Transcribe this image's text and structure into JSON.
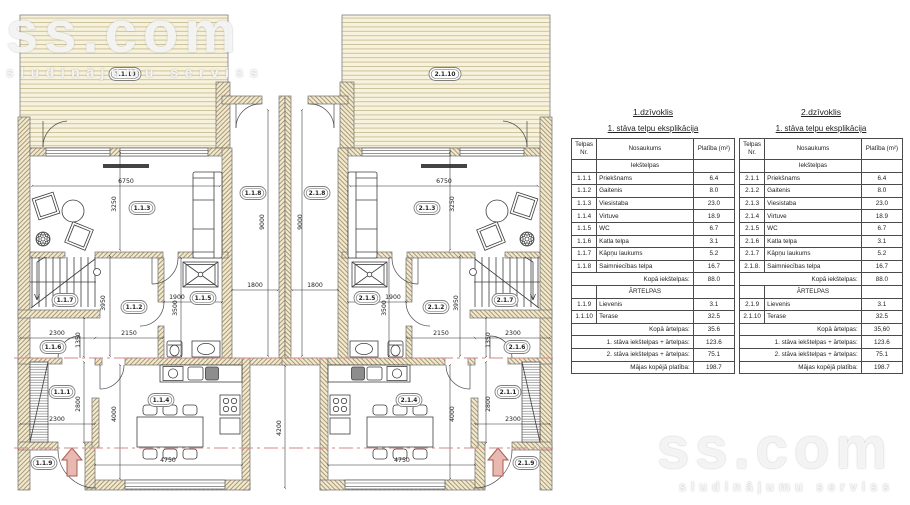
{
  "watermark": {
    "brand": "ss.com",
    "tagline": "sludinājumu serviss"
  },
  "colors": {
    "wall_hatch": "#a5936c",
    "wall_fill": "#f0e8cf",
    "deck_fill": "#f7f2dd",
    "deck_line": "#c3b88b",
    "section_line": "#d58a8a",
    "entry_arrow": "#e7b9b1"
  },
  "plan": {
    "rooms": {
      "u1_terrace": "1.1.10",
      "u1_living": "1.1.3",
      "u1_utility": "1.1.8",
      "u1_stairs": "1.1.7",
      "u1_hall2": "1.1.2",
      "u1_wc": "1.1.5",
      "u1_boiler": "1.1.6",
      "u1_entry": "1.1.1",
      "u1_kitchen": "1.1.4",
      "u1_porch": "1.1.9",
      "u2_terrace": "2.1.10",
      "u2_living": "2.1.3",
      "u2_utility": "2.1.8",
      "u2_stairs": "2.1.7",
      "u2_hall2": "2.1.2",
      "u2_wc": "2.1.5",
      "u2_boiler": "2.1.6",
      "u2_entry": "2.1.1",
      "u2_kitchen": "2.1.4",
      "u2_porch": "2.1.9"
    },
    "dims": {
      "living_w": "6750",
      "living_h": "3250",
      "corridor_h": "3950",
      "wc_h": "3500",
      "wc_w": "1900",
      "boiler_w": "2300",
      "boiler_h": "1350",
      "corridor_w": "2150",
      "hall_h": "2800",
      "hall_w": "2300",
      "kitchen_h": "4000",
      "kitchen_w": "4750",
      "utility_w": "1800",
      "utility_h": "9000",
      "court_h": "4200"
    }
  },
  "tables": [
    {
      "title": "1.dzīvoklis",
      "subtitle": "1. stāva telpu eksplikācija",
      "columns": [
        "Telpas Nr.",
        "Nosaukums",
        "Platība (m²)"
      ],
      "section_inner": "Iekštelpas",
      "rows_inner": [
        [
          "1.1.1",
          "Priekšnams",
          "6.4"
        ],
        [
          "1.1.2",
          "Gaitenis",
          "8.0"
        ],
        [
          "1.1.3",
          "Viesistaba",
          "23.0"
        ],
        [
          "1.1.4",
          "Virtuve",
          "18.9"
        ],
        [
          "1.1.5",
          "WC",
          "6.7"
        ],
        [
          "1.1.6",
          "Katla telpa",
          "3.1"
        ],
        [
          "1.1.7",
          "Kāpņu laukums",
          "5.2"
        ],
        [
          "1.1.8",
          "Saimniecības telpa",
          "16.7"
        ]
      ],
      "total_inner": [
        "Kopā iekštelpas:",
        "88.0"
      ],
      "section_outer": "ĀRTELPAS",
      "rows_outer": [
        [
          "1.1.9",
          "Lievenis",
          "3.1"
        ],
        [
          "1.1.10",
          "Terase",
          "32.5"
        ]
      ],
      "total_outer": [
        "Kopā ārtelpas:",
        "35.6"
      ],
      "summary": [
        [
          "1. stāva iekštelpas + ārtelpas:",
          "123.6"
        ],
        [
          "2. stāva iekštelpas + ārtelpas:",
          "75.1"
        ],
        [
          "Mājas kopējā platība:",
          "198.7"
        ]
      ]
    },
    {
      "title": "2.dzīvoklis",
      "subtitle": "1. stāva telpu eksplikācija",
      "columns": [
        "Telpas Nr.",
        "Nosaukums",
        "Platība (m²)"
      ],
      "section_inner": "Iekštelpas",
      "rows_inner": [
        [
          "2.1.1",
          "Priekšnams",
          "6.4"
        ],
        [
          "2.1.2",
          "Gaitenis",
          "8.0"
        ],
        [
          "2.1.3",
          "Viesistaba",
          "23.0"
        ],
        [
          "2.1.4",
          "Virtuve",
          "18.9"
        ],
        [
          "2.1.5",
          "WC",
          "6.7"
        ],
        [
          "2.1.6",
          "Katla telpa",
          "3.1"
        ],
        [
          "2.1.7",
          "Kāpņu laukums",
          "5.2"
        ],
        [
          "2.1.8.",
          "Saimniecības telpa",
          "16.7"
        ]
      ],
      "total_inner": [
        "Kopā iekštelpas:",
        "88.0"
      ],
      "section_outer": "ĀRTELPAS",
      "rows_outer": [
        [
          "2.1.9",
          "Lievenis",
          "3.1"
        ],
        [
          "2.1.10",
          "Terase",
          "32.5"
        ]
      ],
      "total_outer": [
        "Kopā ārtelpas:",
        "35,60"
      ],
      "summary": [
        [
          "1. stāva iekštelpas + ārtelpas:",
          "123.6"
        ],
        [
          "2. stāva iekštelpas + ārtelpas:",
          "75.1"
        ],
        [
          "Mājas kopējā platība:",
          "198.7"
        ]
      ]
    }
  ]
}
